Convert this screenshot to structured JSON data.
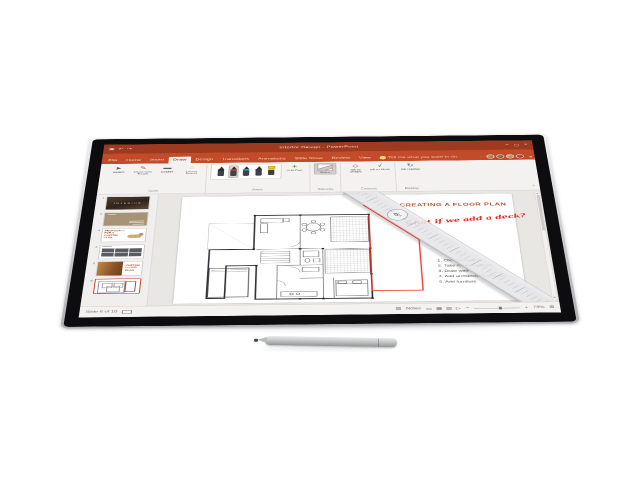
{
  "app": {
    "name": "PowerPoint",
    "accent_color": "#C24B29",
    "titlebar_color": "#9E3A1F"
  },
  "titlebar": {
    "title": "Interior Design - PowerPoint",
    "qat_icons": {
      "save": "▣",
      "undo": "↶",
      "redo": "↷"
    },
    "window_icons": {
      "minimize": "–",
      "maximize": "▢",
      "close": "×"
    }
  },
  "tabs": [
    {
      "label": "File"
    },
    {
      "label": "Home"
    },
    {
      "label": "Insert"
    },
    {
      "label": "Draw",
      "active": true
    },
    {
      "label": "Design"
    },
    {
      "label": "Transitions"
    },
    {
      "label": "Animations"
    },
    {
      "label": "Slide Show"
    },
    {
      "label": "Review"
    },
    {
      "label": "View"
    }
  ],
  "tell_me": "Tell me what you want to do",
  "collaborators": {
    "count": 4
  },
  "ribbon": {
    "groups": [
      {
        "label": "Tools",
        "buttons": [
          {
            "label": "Select",
            "icon": "►"
          },
          {
            "label": "Draw with Touch",
            "icon": "✎"
          },
          {
            "label": "Eraser",
            "icon": "▬"
          },
          {
            "label": "Lasso Select",
            "icon": "◌"
          }
        ]
      },
      {
        "label": "Pens",
        "pens": [
          {
            "name": "black-pen",
            "color": "#2b2b2b"
          },
          {
            "name": "red-pen",
            "color": "#e03c31",
            "selected": true
          },
          {
            "name": "teal-pen",
            "color": "#2ea3b4"
          },
          {
            "name": "blue-pen",
            "color": "#2b3a6b"
          },
          {
            "name": "yellow-highlighter",
            "color": "#f4cd1f"
          }
        ],
        "add_label": "Add Pen",
        "add_icon": "+"
      },
      {
        "label": "Stencils",
        "buttons": [
          {
            "label": "Ruler",
            "active": true
          }
        ]
      },
      {
        "label": "Convert",
        "buttons": [
          {
            "label": "Ink to Shape",
            "icon": "◇"
          },
          {
            "label": "Ink to Math",
            "icon": "√"
          }
        ]
      },
      {
        "label": "Replay",
        "buttons": [
          {
            "label": "Ink Replay",
            "icon": "↻"
          }
        ]
      }
    ],
    "collapse_icon": "^"
  },
  "thumbnails": [
    {
      "num": "1",
      "title": "INTERIOR"
    },
    {
      "num": "2",
      "title": ""
    },
    {
      "num": "3",
      "title": "PROPOSALS FOR A CUSTOM PLAN"
    },
    {
      "num": "4",
      "title": ""
    },
    {
      "num": "5",
      "title": "CUSTOM FLOOR PLAN"
    },
    {
      "num": "6",
      "title": "",
      "selected": true
    }
  ],
  "slide": {
    "title": "CREATING A FLOOR PLAN",
    "title_color": "#B5512F",
    "ink_note": "what if we add a deck?",
    "ink_color": "#E6261B",
    "ruler_dial": "45°",
    "steps": [
      "1. Choose an area",
      "2. Take measurements",
      "3. Draw walls",
      "4. Add architectural features",
      "5. Add furniture"
    ]
  },
  "statusbar": {
    "slide_info": "Slide 6 of 10",
    "notes_icon": "▤",
    "notes_label": "Notes",
    "view_icons": {
      "normal": "▭",
      "sorter": "▦",
      "reading": "▥",
      "slideshow": "▷"
    },
    "zoom_minus": "−",
    "zoom_plus": "+",
    "zoom_percent": "73%",
    "fit_icon": "⊞"
  }
}
